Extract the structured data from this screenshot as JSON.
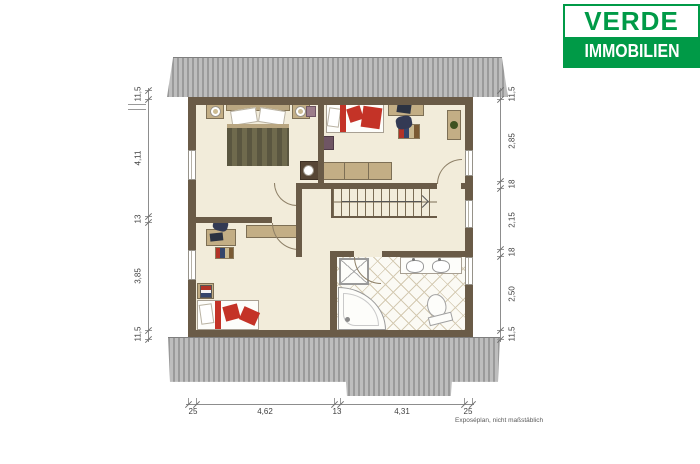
{
  "logo": {
    "brand_top": "VERDE",
    "brand_bottom": "IMMOBILIEN"
  },
  "plan": {
    "footnote": "Exposéplan, nicht maßstäblich",
    "dims_left": [
      "11,5",
      "4,11",
      "13",
      "3,85",
      "11,5"
    ],
    "dims_right": [
      "11,5",
      "2,85",
      "18",
      "2,15",
      "18",
      "2,50",
      "11,5"
    ],
    "dims_bottom": [
      "25",
      "4,62",
      "13",
      "4,31",
      "25"
    ]
  },
  "colors": {
    "logo_green": "#009a47",
    "wall_brown": "#6a5b47",
    "floor_cream": "#f2ecda",
    "accent_red": "#c43327",
    "furniture_tan": "#c3ae85",
    "roof_gray": "#b0b0b0"
  }
}
